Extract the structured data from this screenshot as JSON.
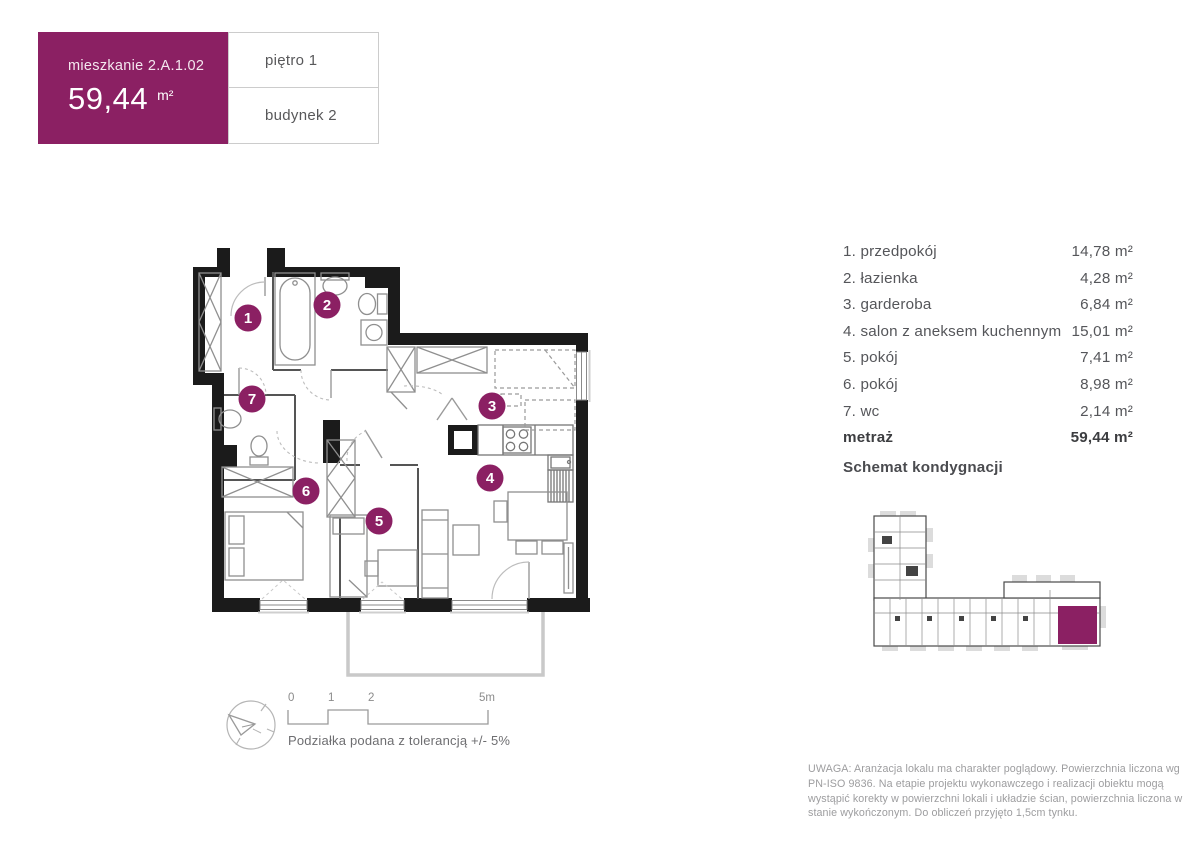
{
  "colors": {
    "accent": "#8B2063",
    "wall": "#1b1b1b",
    "furniture": "#8f8f8f",
    "balcony": "#c9c9c9",
    "text": "#55565a",
    "muted": "#9d9d9f"
  },
  "header": {
    "title": "mieszkanie 2.A.1.02",
    "area_value": "59,44",
    "area_unit": "m²",
    "floor_label": "piętro 1",
    "building_label": "budynek 2"
  },
  "room_list": {
    "items": [
      {
        "label": "1. przedpokój",
        "area": "14,78 m²"
      },
      {
        "label": "2. łazienka",
        "area": "4,28 m²"
      },
      {
        "label": "3. garderoba",
        "area": "6,84 m²"
      },
      {
        "label": "4. salon z aneksem kuchennym",
        "area": "15,01 m²"
      },
      {
        "label": "5. pokój",
        "area": "7,41 m²"
      },
      {
        "label": "6. pokój",
        "area": "8,98 m²"
      },
      {
        "label": "7. wc",
        "area": "2,14 m²"
      }
    ],
    "total_label": "metraż",
    "total_area": "59,44 m²"
  },
  "plan": {
    "badges": [
      "1",
      "2",
      "3",
      "4",
      "5",
      "6",
      "7"
    ]
  },
  "schematic": {
    "title": "Schemat kondygnacji"
  },
  "scale_bar": {
    "ticks": [
      "0",
      "1",
      "2",
      "5m"
    ],
    "caption": "Podziałka podana z tolerancją +/- 5%"
  },
  "disclaimer": "UWAGA: Aranżacja lokalu ma charakter poglądowy. Powierzchnia liczona wg PN-ISO 9836. Na etapie projektu wykonawczego i realizacji obiektu mogą wystąpić korekty w powierzchni lokali i układzie ścian, powierzchnia liczona w stanie wykończonym. Do obliczeń przyjęto 1,5cm tynku."
}
